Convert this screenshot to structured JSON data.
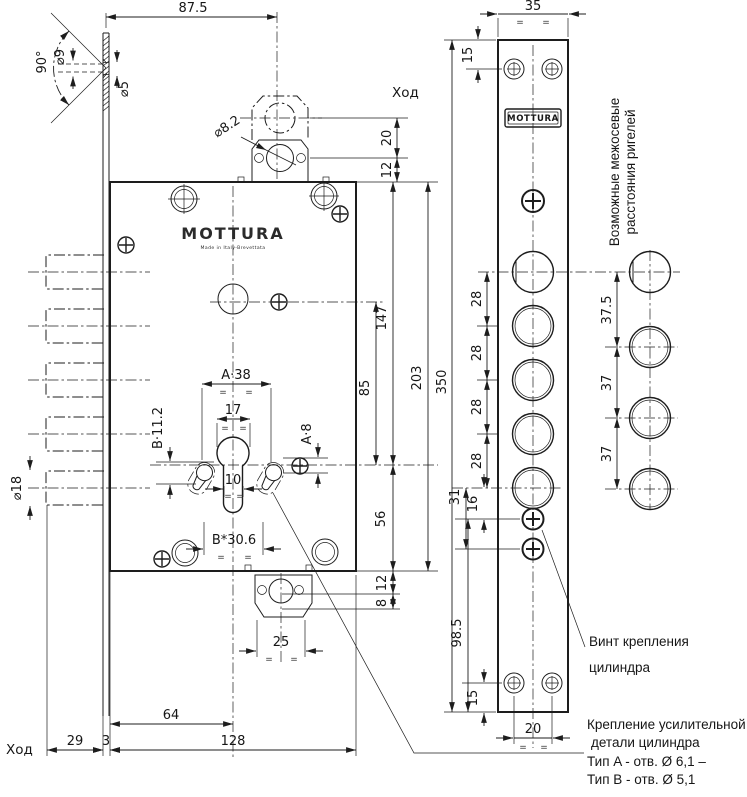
{
  "brand": {
    "name": "MOTTURA",
    "subtitle": "Made in Italy-Brevettata",
    "badge": "MOTTURA"
  },
  "labels": {
    "stroke_top": "Ход",
    "stroke_bottom": "Ход",
    "axle_note": [
      "Возможные межосевые",
      "расстояния ригелей"
    ],
    "cylinder_screw_note": [
      "Винт крепления",
      "цилиндра"
    ],
    "reinforcement_note": [
      "Крепление усилительной",
      "детали цилиндра",
      "Тип A - отв. Ø 6,1 –",
      "Тип B - отв. Ø 5,1"
    ]
  },
  "dims": {
    "top_width": "87.5",
    "plate_width": "35",
    "plate_screw_top": "15",
    "latch_stroke": "20",
    "latch_offset": "12",
    "countersink_angle": "90°",
    "countersink_dia": "⌀9",
    "hole_dia": "⌀5",
    "latch_hole_dia": "⌀8.2",
    "bolt_dia": "⌀18",
    "body_cyl_top": "147",
    "circle_cyl": "85",
    "body_height": "203",
    "cyl_bottom": "56",
    "bracket_offset_12": "12",
    "bracket_offset_8": "8",
    "keyway_span": "A·38",
    "keyway_width": "17",
    "keyway_b_offset": "B·11.2",
    "keyway_a_offset": "A·8",
    "stem_width": "10",
    "keyway_b_span": "B*30.6",
    "bracket_width": "25",
    "stroke_29": "29",
    "plate_thickness": "3",
    "backset": "64",
    "body_depth": "128",
    "plate_height": "350",
    "bolt_step": "28",
    "screw_31": "31",
    "screw_16": "16",
    "plate_bottom": "98.5",
    "plate_screw_bottom": "15",
    "screw_span": "20",
    "alt_step_first": "37.5",
    "alt_step": "37"
  },
  "symbols": {
    "equals": "="
  }
}
